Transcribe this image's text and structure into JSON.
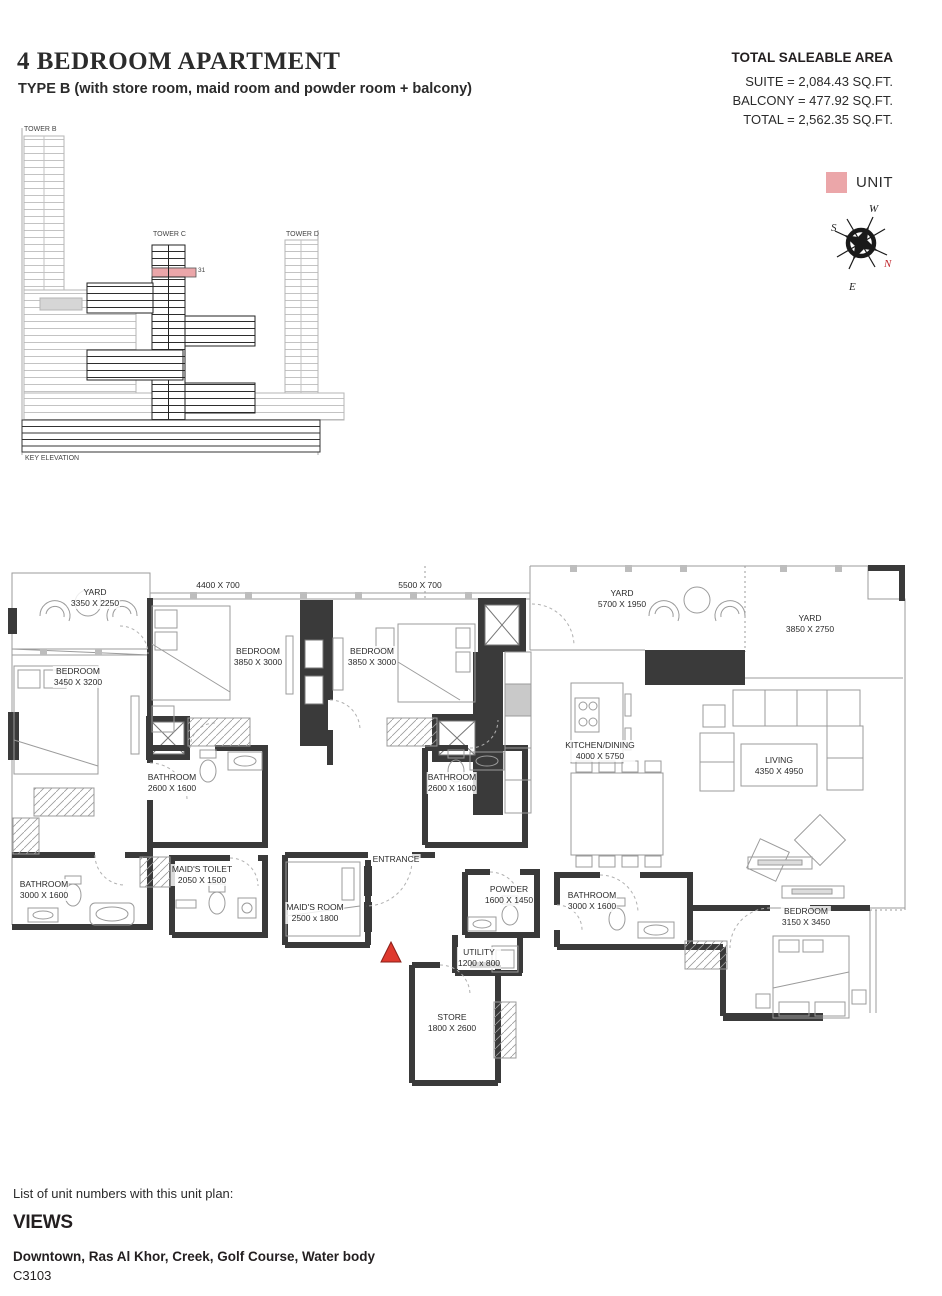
{
  "header": {
    "title": "4 BEDROOM APARTMENT",
    "subtitle": "TYPE B (with store room, maid room and powder room + balcony)"
  },
  "area_summary": {
    "title": "TOTAL SALEABLE AREA",
    "suite": "SUITE = 2,084.43 SQ.FT.",
    "balcony": "BALCONY = 477.92 SQ.FT.",
    "total": "TOTAL = 2,562.35 SQ.FT."
  },
  "key_elevation": {
    "tower_b": "TOWER B",
    "tower_c": "TOWER C",
    "tower_d": "TOWER D",
    "highlighted_floor": "31",
    "caption": "KEY ELEVATION"
  },
  "legend": {
    "unit_label": "UNIT",
    "unit_color": "#eba6a9"
  },
  "compass": {
    "n": "N",
    "e": "E",
    "s": "S",
    "w": "W"
  },
  "floor_plan": {
    "entrance_label": "ENTRANCE",
    "balcony_dims": [
      "4400 X 700",
      "5500 X 700"
    ],
    "rooms": [
      {
        "name": "YARD",
        "dims": "3350 X 2250"
      },
      {
        "name": "BEDROOM",
        "dims": "3850 X 3000"
      },
      {
        "name": "BEDROOM",
        "dims": "3850 X 3000"
      },
      {
        "name": "YARD",
        "dims": "5700 X 1950"
      },
      {
        "name": "YARD",
        "dims": "3850 X 2750"
      },
      {
        "name": "BEDROOM",
        "dims": "3450 X 3200"
      },
      {
        "name": "KITCHEN/DINING",
        "dims": "4000 X 5750"
      },
      {
        "name": "LIVING",
        "dims": "4350 X 4950"
      },
      {
        "name": "BATHROOM",
        "dims": "2600 X 1600"
      },
      {
        "name": "BATHROOM",
        "dims": "2600 X 1600"
      },
      {
        "name": "BATHROOM",
        "dims": "3000 X 1600"
      },
      {
        "name": "MAID'S TOILET",
        "dims": "2050 X 1500"
      },
      {
        "name": "MAID'S ROOM",
        "dims": "2500 x 1800"
      },
      {
        "name": "POWDER",
        "dims": "1600 X 1450"
      },
      {
        "name": "BATHROOM",
        "dims": "3000 X 1600"
      },
      {
        "name": "UTILITY",
        "dims": "1200 x 800"
      },
      {
        "name": "STORE",
        "dims": "1800 X 2600"
      },
      {
        "name": "BEDROOM",
        "dims": "3150 X 3450"
      }
    ]
  },
  "footer": {
    "list_label": "List of unit numbers with this unit plan:",
    "views_title": "VIEWS",
    "views": "Downtown, Ras Al Khor, Creek, Golf Course, Water body",
    "unit_number": "C3103"
  },
  "colors": {
    "unit_pink": "#eba6a9",
    "wall_dark": "#3a3a3a",
    "line_gray": "#9b9b9b",
    "compass_north_red": "#c0272d",
    "entrance_triangle_red": "#df392e"
  }
}
